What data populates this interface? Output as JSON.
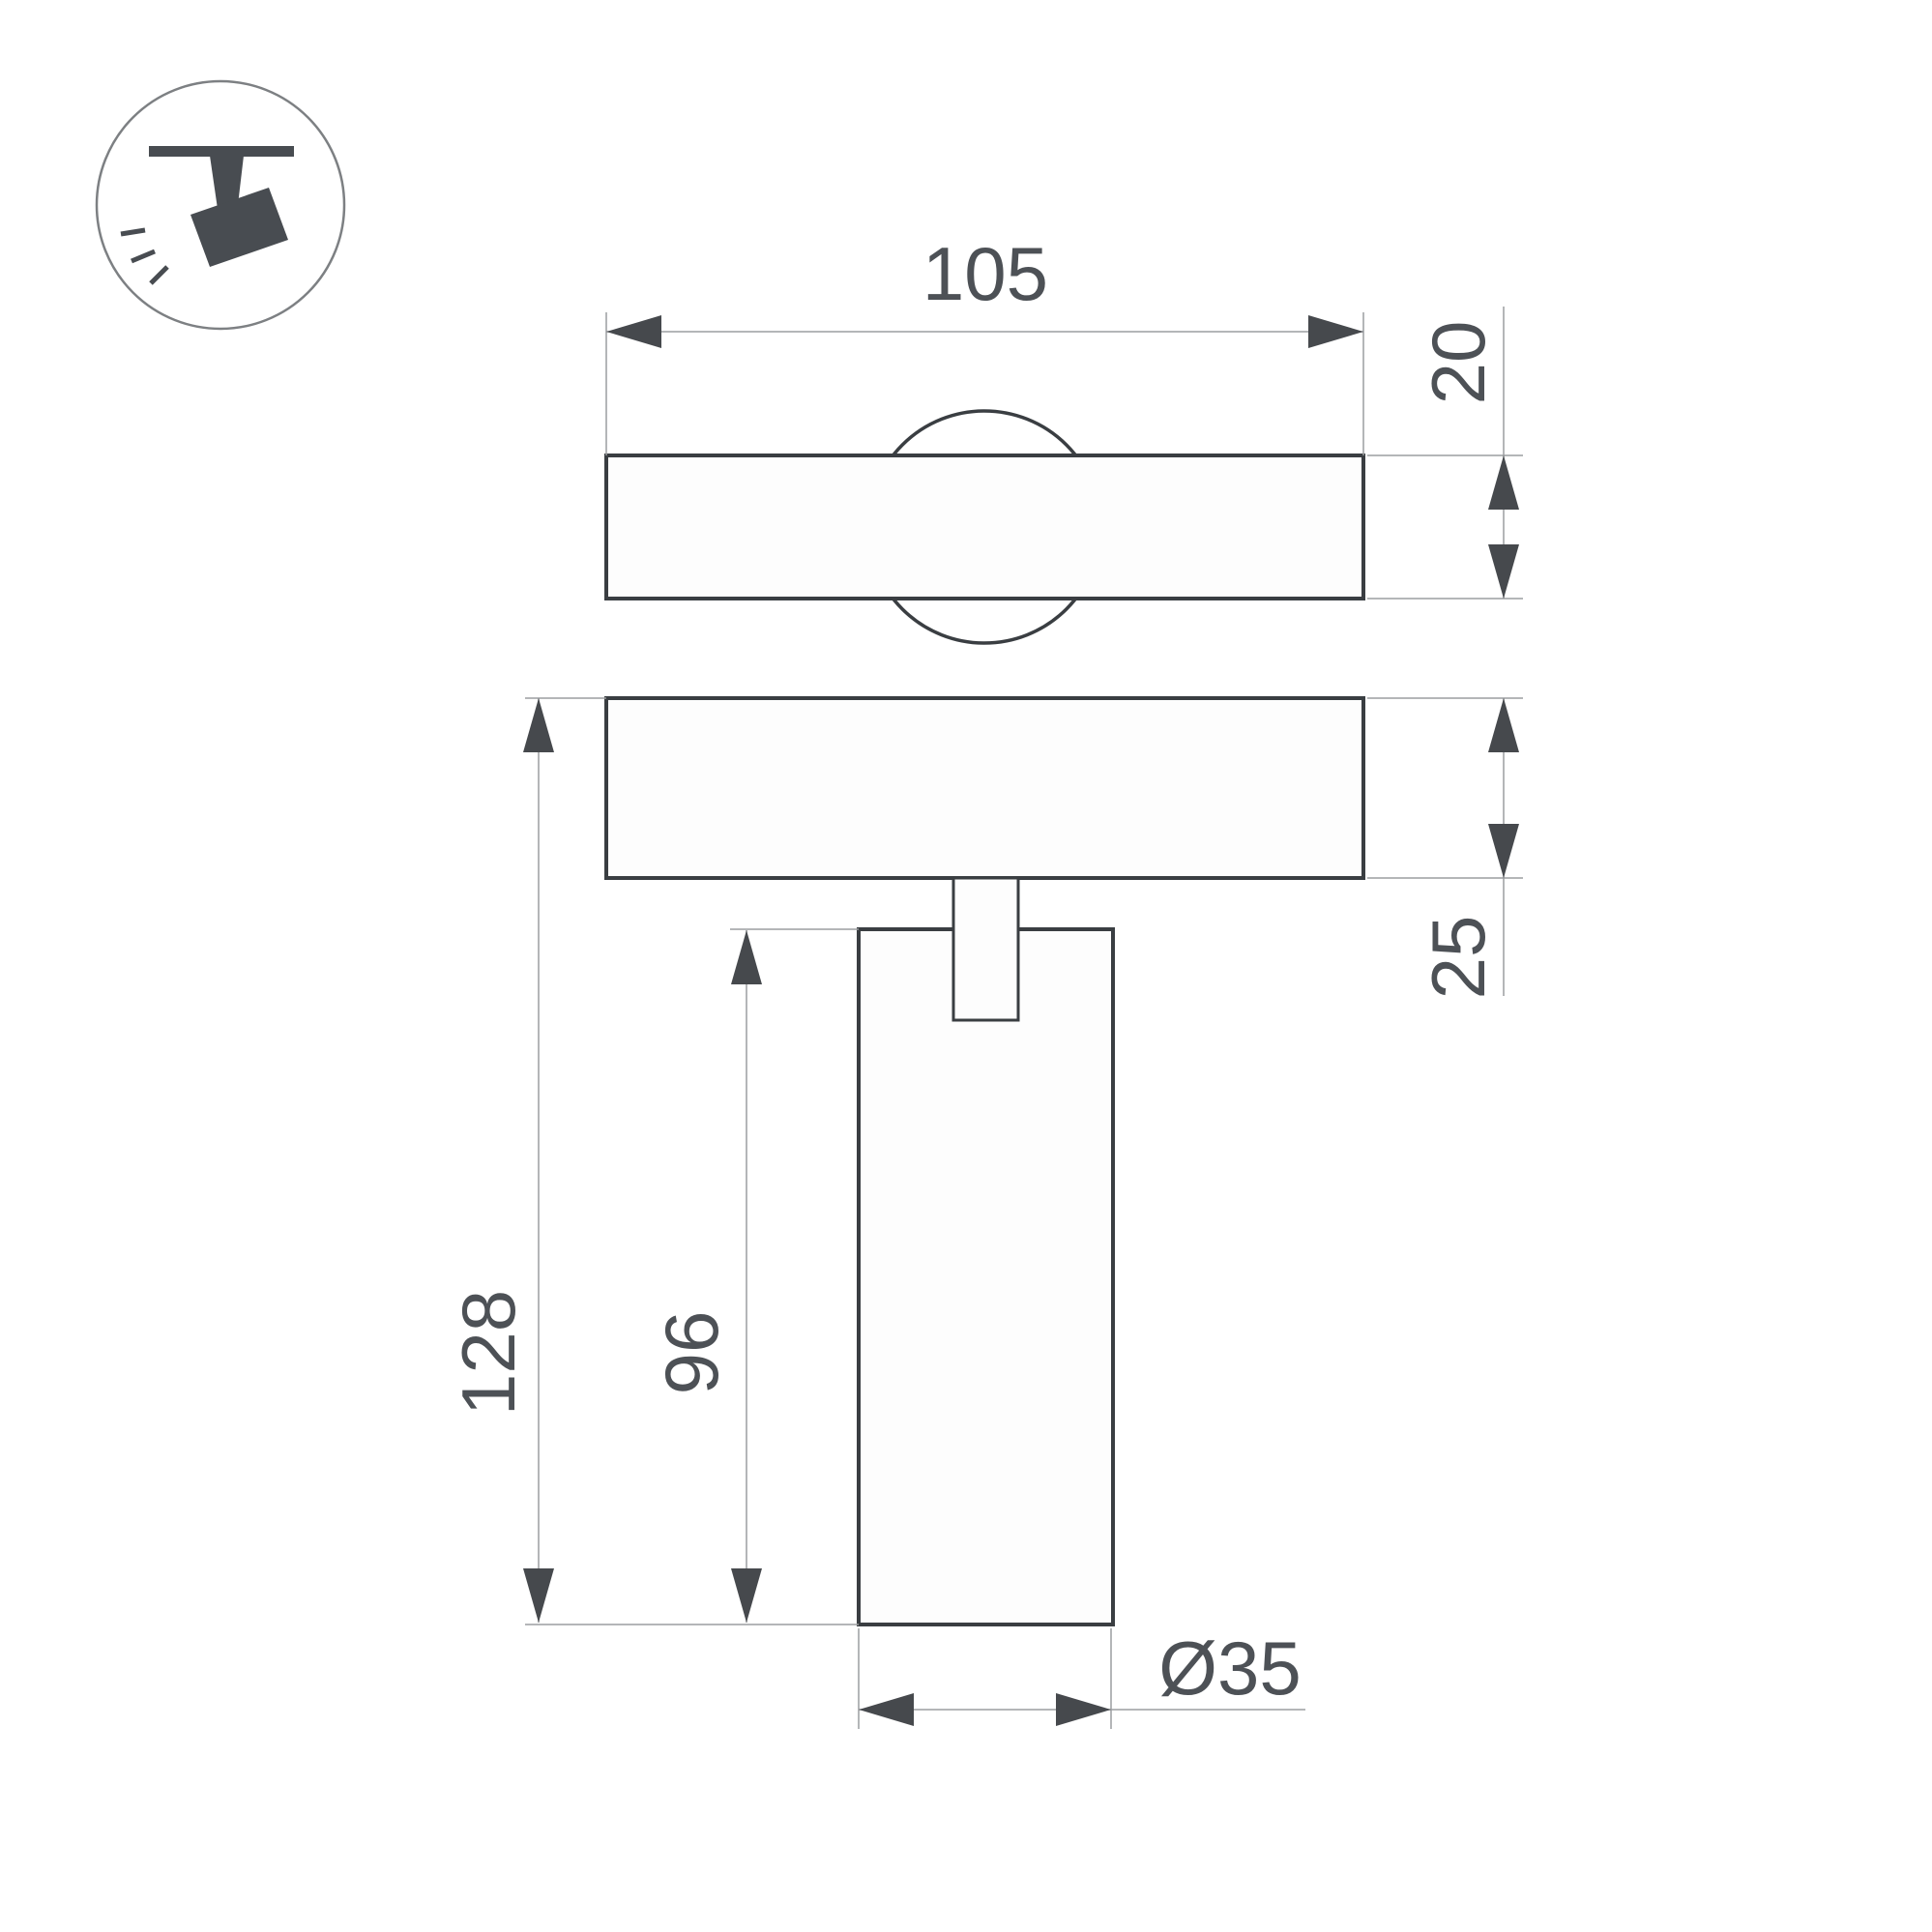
{
  "page": {
    "background": "#ffffff"
  },
  "icon": {
    "name": "ceiling-track-spotlight",
    "glyph_color": "#484c51",
    "ring_color": "#7d8083"
  },
  "drawing": {
    "type": "technical-dimension-drawing",
    "outline_color": "#3a3e42",
    "dimension_line_color": "#9b9da0",
    "text_color": "#4d5156",
    "labels": {
      "track_width": "105",
      "track_thickness": "20",
      "base_thickness": "25",
      "overall_height": "128",
      "body_height": "96",
      "body_diameter": "Ø35"
    }
  }
}
